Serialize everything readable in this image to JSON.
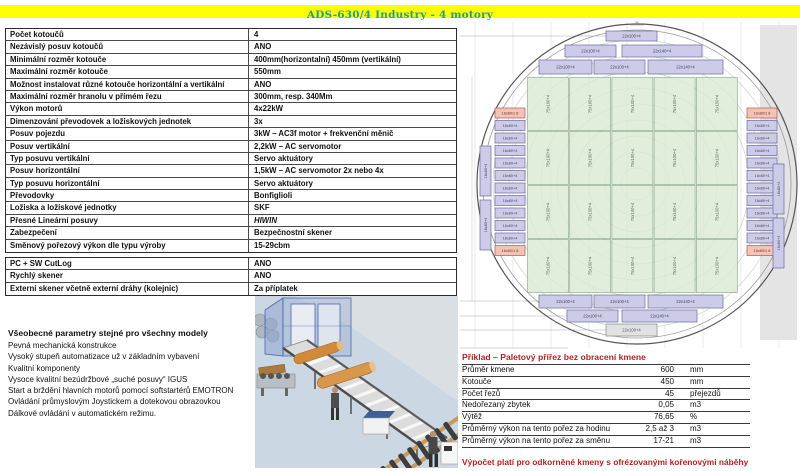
{
  "title": "ADS-630/4 Industry - 4 motory",
  "spec_table": {
    "rows": [
      {
        "label": "Počet kotoučů",
        "value": "4"
      },
      {
        "label": "Nezávislý posuv kotoučů",
        "value": "ANO"
      },
      {
        "label": "Minimální rozměr kotouče",
        "value": "400mm(horizontalní) 450mm (vertikální)"
      },
      {
        "label": "Maximální rozměr kotouče",
        "value": "550mm"
      },
      {
        "label": "Možnost instalovat různé kotouče horizontální a vertikální",
        "value": "ANO"
      },
      {
        "label": "Maximální rozměr hranolu v přímém řezu",
        "value": "300mm, resp. 340Mm"
      },
      {
        "label": "Výkon motorů",
        "value": "4x22kW"
      },
      {
        "label": "Dimenzování převodovek a ložiskových jednotek",
        "value": "3x"
      },
      {
        "label": "Posuv pojezdu",
        "value": "3kW – AC3f motor + frekvenční měnič"
      },
      {
        "label": "Posuv vertikální",
        "value": "2,2kW – AC servomotor"
      },
      {
        "label": "Typ posuvu vertikální",
        "value": "Servo aktuátory"
      },
      {
        "label": "Posuv horizontální",
        "value": "1,5kW – AC servomotor  2x nebo 4x"
      },
      {
        "label": "Typ posuvu horizontální",
        "value": "Servo aktuátory"
      },
      {
        "label": "Převodovky",
        "value": "Bonfiglioli"
      },
      {
        "label": "Ložiska a ložiskové jednotky",
        "value": "SKF"
      },
      {
        "label": "Přesné Lineární posuvy",
        "value": "HIWIN"
      },
      {
        "label": "Zabezpečení",
        "value": "Bezpečnostní skener"
      },
      {
        "label": "Směnový pořezový výkon dle typu výroby",
        "value": "15-29cbm"
      }
    ]
  },
  "options_table": {
    "rows": [
      {
        "label": "PC + SW CutLog",
        "value": "ANO"
      },
      {
        "label": "Rychlý skener",
        "value": "ANO"
      },
      {
        "label": "Externí skener včetně externí dráhy (kolejnic)",
        "value": "Za příplatek"
      }
    ]
  },
  "features": {
    "heading": "Všeobecné parametry stejné pro všechny modely",
    "items": [
      "Pevná mechanická konstrukce",
      "Vysoký stupeň automatizace už v základním vybavení",
      "Kvalitní komponenty",
      "Vysoce kvalitní bezúdržbové „suché posuvy“  IGUS",
      "Start a brždění hlavních motorů pomocí softstartérů EMOTRON",
      "Ovládání průmyslovým Joystickem a dotekovou obrazovkou",
      "Dálkové ovládání v automatickém režimu."
    ]
  },
  "example": {
    "title": "Příklad – Paletový přířez bez obracení kmene",
    "rows": [
      {
        "label": "Průměr kmene",
        "value": "600",
        "unit": "mm"
      },
      {
        "label": "Kotouče",
        "value": "450",
        "unit": "mm"
      },
      {
        "label": "Počet řezů",
        "value": "45",
        "unit": "přejezdů"
      },
      {
        "label": "Nedořezaný zbytek",
        "value": "0,05",
        "unit": "m3"
      },
      {
        "label": "Výtěž",
        "value": "76,65",
        "unit": "%"
      },
      {
        "label": "Průměrný výkon na tento pořez za hodinu",
        "value": "2,5 až 3",
        "unit": "m3"
      },
      {
        "label": "Průměrný výkon na tento pořez za směnu",
        "value": "17-21",
        "unit": "m3"
      }
    ],
    "footer": "Výpočet platí pro odkorněné kmeny s ofrézovanými kořenovými náběhy"
  },
  "diagram": {
    "strip_100": "22x100+4",
    "strip_140": "22x140+4",
    "green_label": "75x100+4",
    "side_label": "16x80+4",
    "side_special_label": "16x80/1 8",
    "dimension_tick": "56"
  },
  "colors": {
    "title_bar": "#ffff00",
    "title_text": "#23a089",
    "red_text": "#b22222",
    "board_lavender": "#cccce8",
    "board_green": "#d9ead3",
    "board_pink": "#f2c4b8"
  }
}
